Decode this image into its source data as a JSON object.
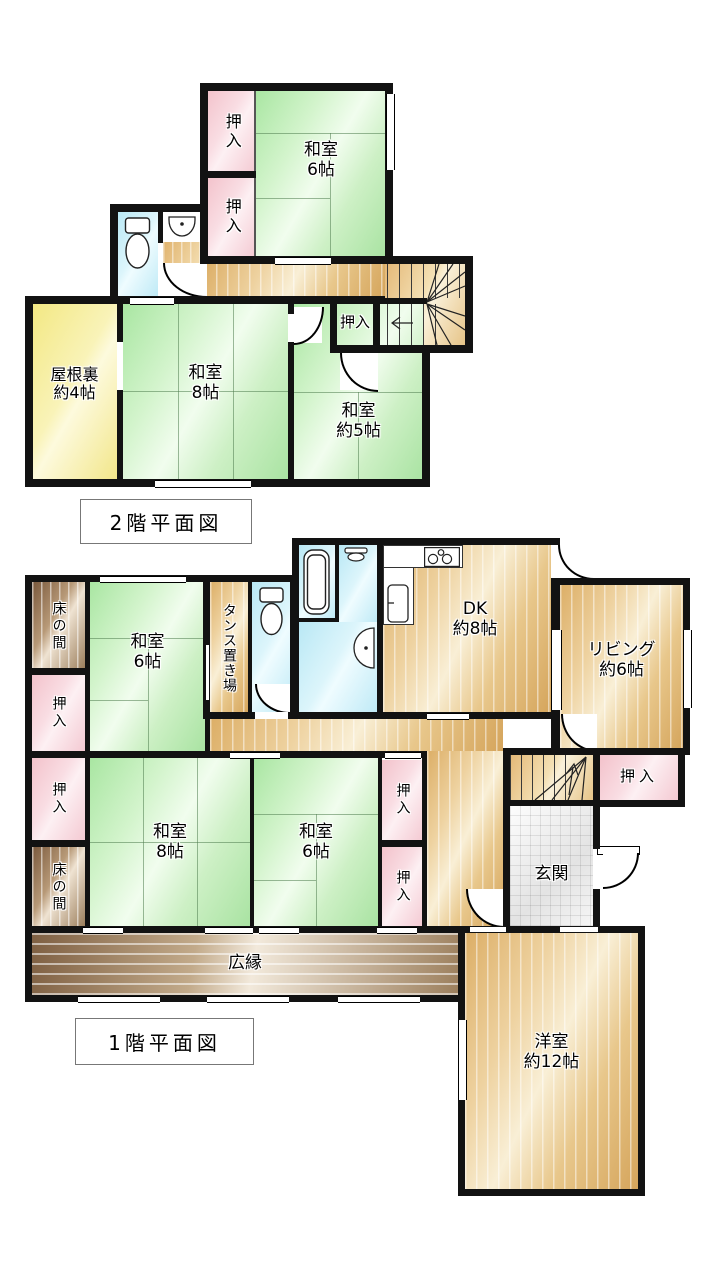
{
  "floor2": {
    "caption": "2階平面図",
    "rooms": {
      "washitsu6": "和室\n6帖",
      "oshiire_top": "押入",
      "oshiire_bottom": "押入",
      "oshiire_stairs": "押入",
      "yaneura": "屋根裏\n約4帖",
      "washitsu8": "和室\n8帖",
      "washitsu5": "和室\n約5帖"
    }
  },
  "floor1": {
    "caption": "1階平面図",
    "rooms": {
      "tokonoma_upper": "床の間",
      "washitsu6_upper": "和室\n6帖",
      "tansu": "タンス置き場",
      "dk": "DK\n約8帖",
      "living": "リビング\n約6帖",
      "oshiire_left_upper": "押入",
      "oshiire_left_lower": "押入",
      "tokonoma_lower": "床の間",
      "washitsu8": "和室\n8帖",
      "washitsu6_lower": "和室\n6帖",
      "oshiire_right_upper": "押入",
      "oshiire_right_lower": "押入",
      "oshiire_stairs": "押入",
      "genkan": "玄関",
      "hiroen": "広縁",
      "youshitsu": "洋室\n約12帖"
    }
  },
  "colors": {
    "wall": "#121212",
    "tatami_green": "#c8f0c1",
    "closet_pink": "#f6ccd4",
    "wood_floor": "#eccb90",
    "attic_yellow": "#f7ef9e",
    "water_blue": "#c8edf8",
    "tokonoma_brown": "#a88d6f",
    "veranda_brown": "#a78c6b",
    "entry_tile": "#ededed"
  }
}
